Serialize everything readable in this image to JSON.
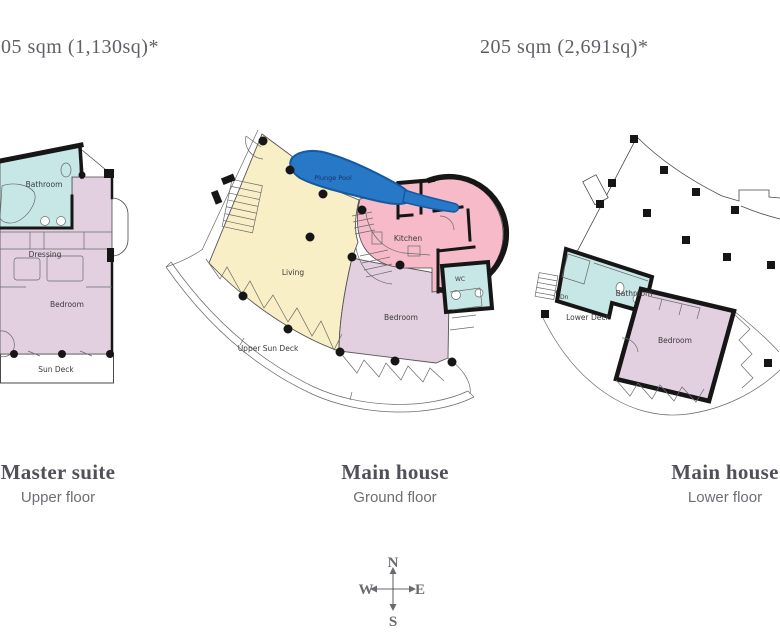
{
  "header": {
    "left_area_label": "05 sqm (1,130sq)*",
    "right_area_label": "205 sqm (2,691sq)*"
  },
  "plans": {
    "master_suite_upper": {
      "title": "Master suite",
      "subtitle": "Upper floor",
      "rooms": {
        "bathroom": "Bathroom",
        "dressing": "Dressing",
        "bedroom": "Bedroom",
        "sun_deck": "Sun Deck"
      }
    },
    "main_house_ground": {
      "title": "Main house",
      "subtitle": "Ground floor",
      "rooms": {
        "plunge_pool": "Plunge Pool",
        "living": "Living",
        "kitchen": "Kitchen",
        "bedroom": "Bedroom",
        "wc": "WC",
        "upper_sun_deck": "Upper Sun Deck"
      }
    },
    "main_house_lower": {
      "title": "Main house",
      "subtitle": "Lower floor",
      "rooms": {
        "bathroom": "Bathroom",
        "lower_deck": "Lower Deck",
        "bedroom": "Bedroom",
        "stairs_down": "Dn"
      }
    }
  },
  "compass": {
    "north": "N",
    "south": "S",
    "east": "E",
    "west": "W"
  },
  "colors": {
    "bathroom_teal": "#c6e7e6",
    "bedroom_lavender": "#e2d0e1",
    "living_cream": "#f9efc6",
    "kitchen_pink": "#f6bac9",
    "pool_blue": "#2878c8",
    "deck_white": "#ffffff",
    "wall_black": "#161616",
    "caption_gray": "#50505a",
    "subcaption_gray": "#6e6e74"
  }
}
